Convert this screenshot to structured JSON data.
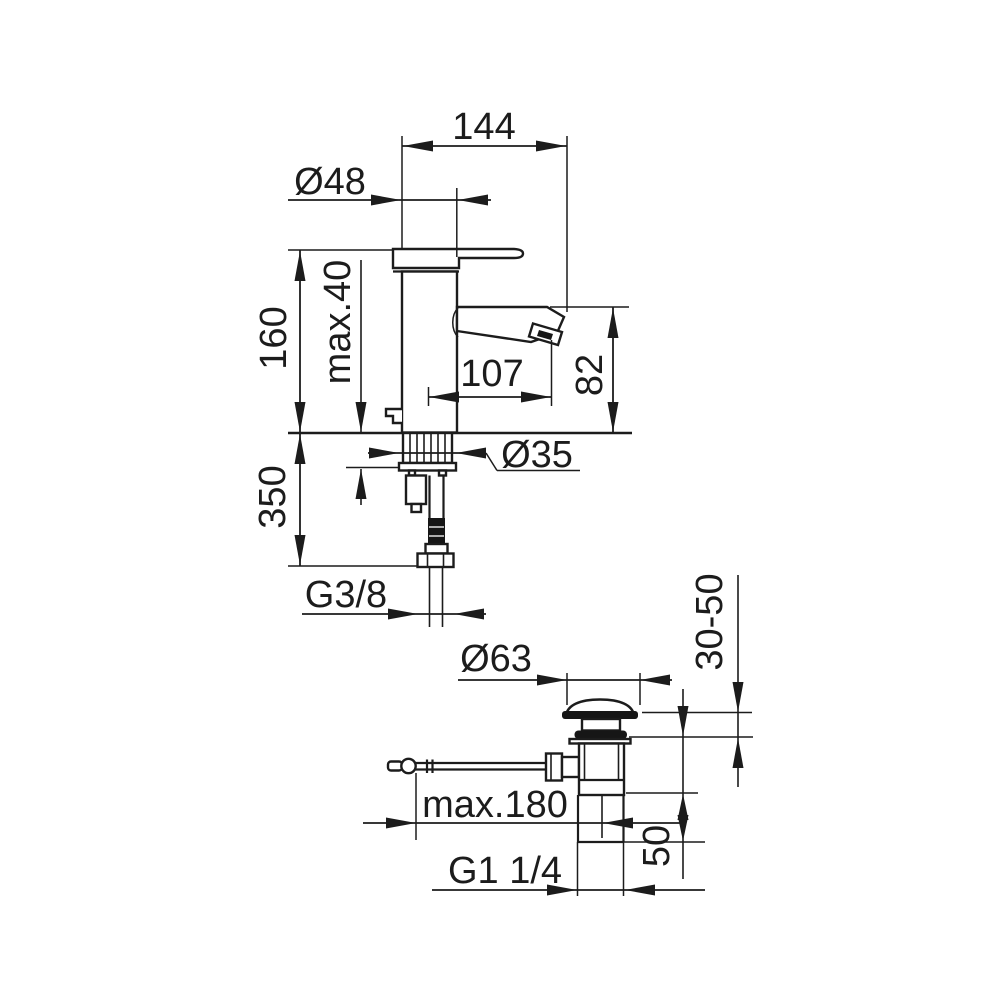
{
  "colors": {
    "line": "#1c1c1c",
    "background": "#ffffff"
  },
  "views": {
    "faucet": {
      "description": "basin mixer side view with mounting shank and supply connection",
      "dims": {
        "total_depth": "144",
        "body_diameter": "Ø48",
        "height": "160",
        "deck_thickness": "max.40",
        "spout_reach": "107",
        "outlet_height": "82",
        "connection_length": "350",
        "hole_diameter": "Ø35",
        "supply_thread": "G3/8"
      }
    },
    "drain": {
      "description": "pop-up waste drain assembly with pull rod",
      "dims": {
        "flange_diameter": "Ø63",
        "clamping_range": "30-50",
        "rod_length": "max.180",
        "tail_length": "50",
        "waste_thread": "G1 1/4"
      }
    }
  }
}
